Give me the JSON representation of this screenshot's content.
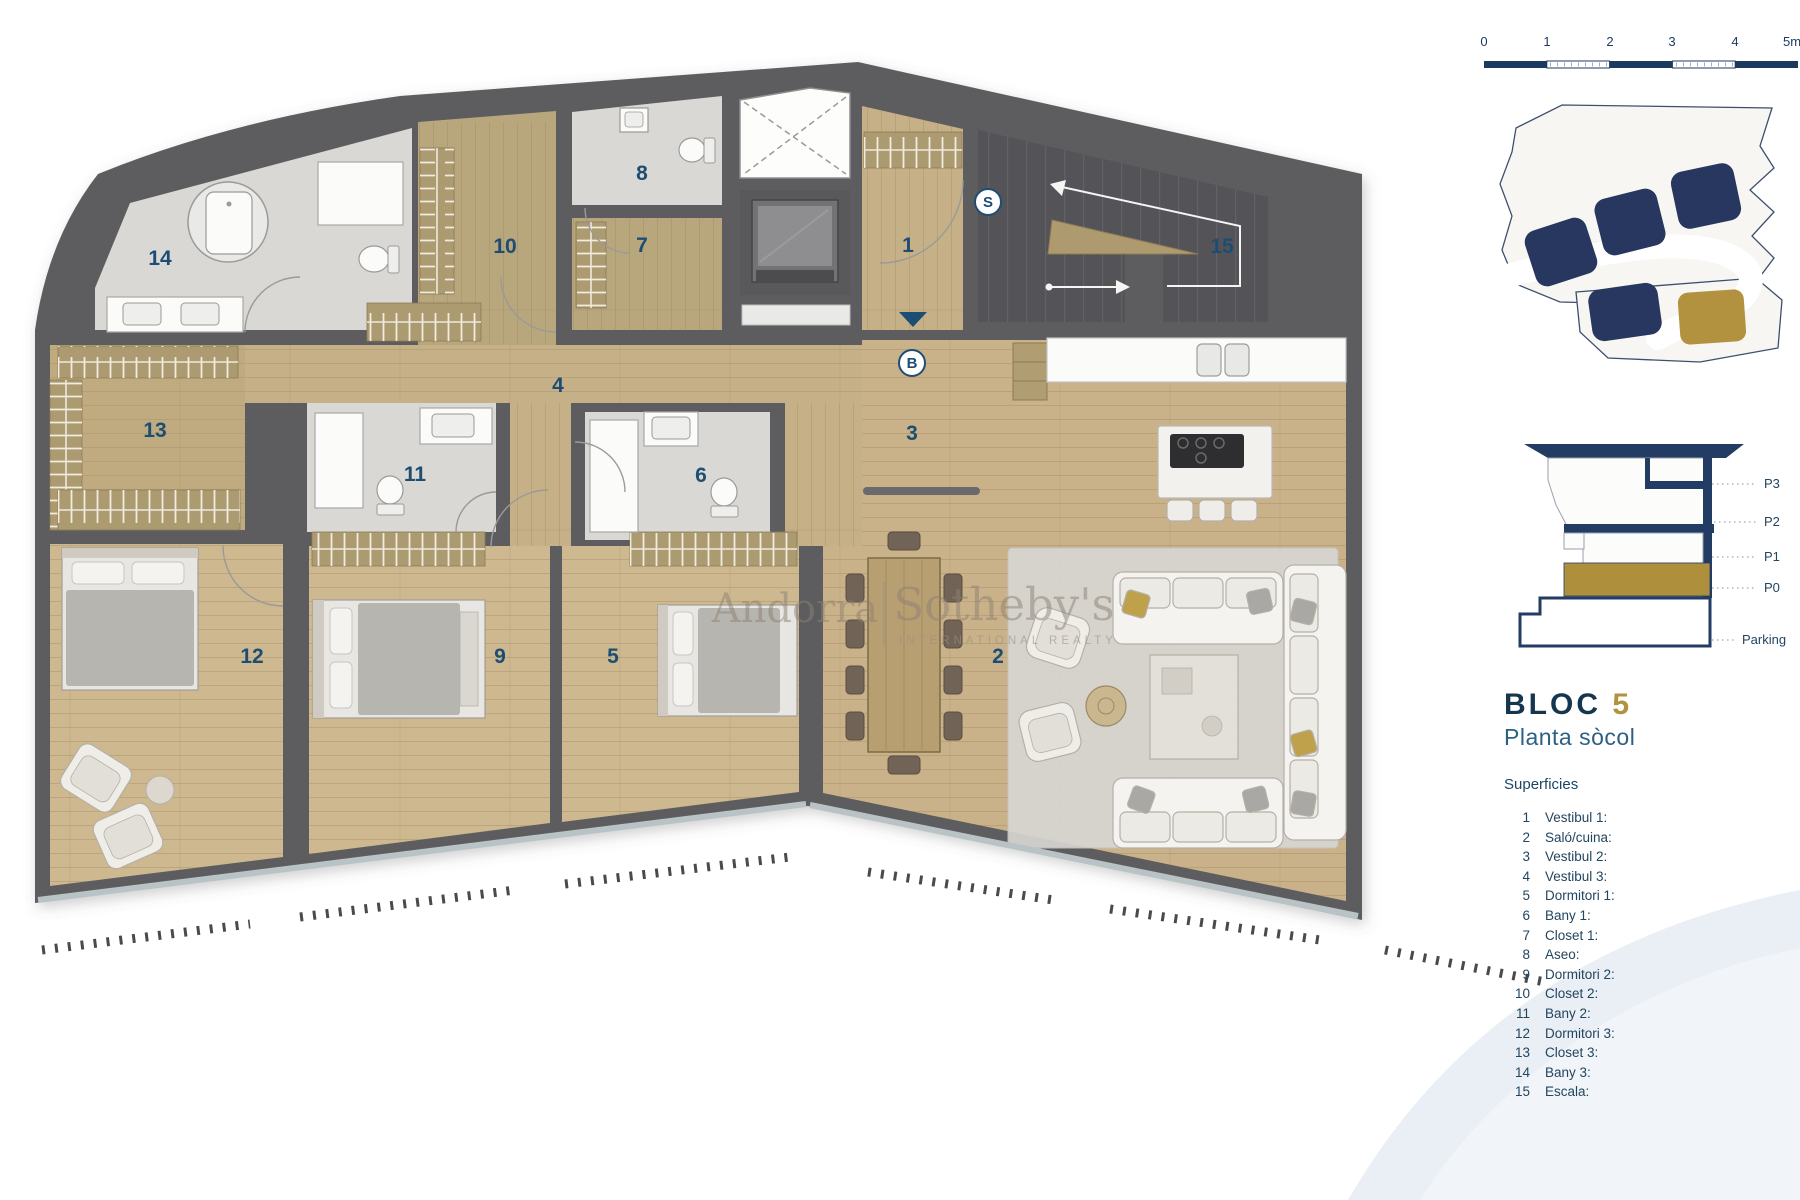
{
  "title_block": {
    "block_word": "BLOC",
    "block_number": "5",
    "floor_name": "Planta sòcol",
    "legend_heading": "Superficies"
  },
  "legend": {
    "items": [
      {
        "num": "1",
        "label": "Vestibul 1:"
      },
      {
        "num": "2",
        "label": "Saló/cuina:"
      },
      {
        "num": "3",
        "label": "Vestibul 2:"
      },
      {
        "num": "4",
        "label": "Vestibul 3:"
      },
      {
        "num": "5",
        "label": "Dormitori 1:"
      },
      {
        "num": "6",
        "label": "Bany 1:"
      },
      {
        "num": "7",
        "label": "Closet 1:"
      },
      {
        "num": "8",
        "label": "Aseo:"
      },
      {
        "num": "9",
        "label": "Dormitori 2:"
      },
      {
        "num": "10",
        "label": "Closet 2:"
      },
      {
        "num": "11",
        "label": "Bany 2:"
      },
      {
        "num": "12",
        "label": "Dormitori 3:"
      },
      {
        "num": "13",
        "label": "Closet 3:"
      },
      {
        "num": "14",
        "label": "Bany 3:"
      },
      {
        "num": "15",
        "label": "Escala:"
      }
    ]
  },
  "scale_bar": {
    "ticks": [
      "0",
      "1",
      "2",
      "3",
      "4",
      "5m"
    ]
  },
  "section": {
    "levels": [
      {
        "label": "P3"
      },
      {
        "label": "P2"
      },
      {
        "label": "P1"
      },
      {
        "label": "P0"
      },
      {
        "label": "Parking"
      }
    ]
  },
  "watermark": {
    "brand_left": "Andorra",
    "brand_right": "Sotheby's",
    "brand_sub": "INTERNATIONAL REALTY"
  },
  "plan": {
    "room_numbers": [
      {
        "id": "vestibul-1",
        "n": "1"
      },
      {
        "id": "salo-cuina",
        "n": "2"
      },
      {
        "id": "vestibul-2",
        "n": "3"
      },
      {
        "id": "vestibul-3",
        "n": "4"
      },
      {
        "id": "dormitori-1",
        "n": "5"
      },
      {
        "id": "bany-1",
        "n": "6"
      },
      {
        "id": "closet-1",
        "n": "7"
      },
      {
        "id": "aseo",
        "n": "8"
      },
      {
        "id": "dormitori-2",
        "n": "9"
      },
      {
        "id": "closet-2",
        "n": "10"
      },
      {
        "id": "bany-2",
        "n": "11"
      },
      {
        "id": "dormitori-3",
        "n": "12"
      },
      {
        "id": "closet-3",
        "n": "13"
      },
      {
        "id": "bany-3",
        "n": "14"
      },
      {
        "id": "escala",
        "n": "15"
      }
    ],
    "markers": [
      {
        "t": "S"
      },
      {
        "t": "B"
      }
    ]
  },
  "colors": {
    "navy": "#1c3a5e",
    "gold": "#b2923e",
    "wall_gray": "#5d5d5f",
    "wood": "#cdb88f",
    "tile": "#d9d8d5",
    "accent_blue_text": "#2d6085"
  }
}
